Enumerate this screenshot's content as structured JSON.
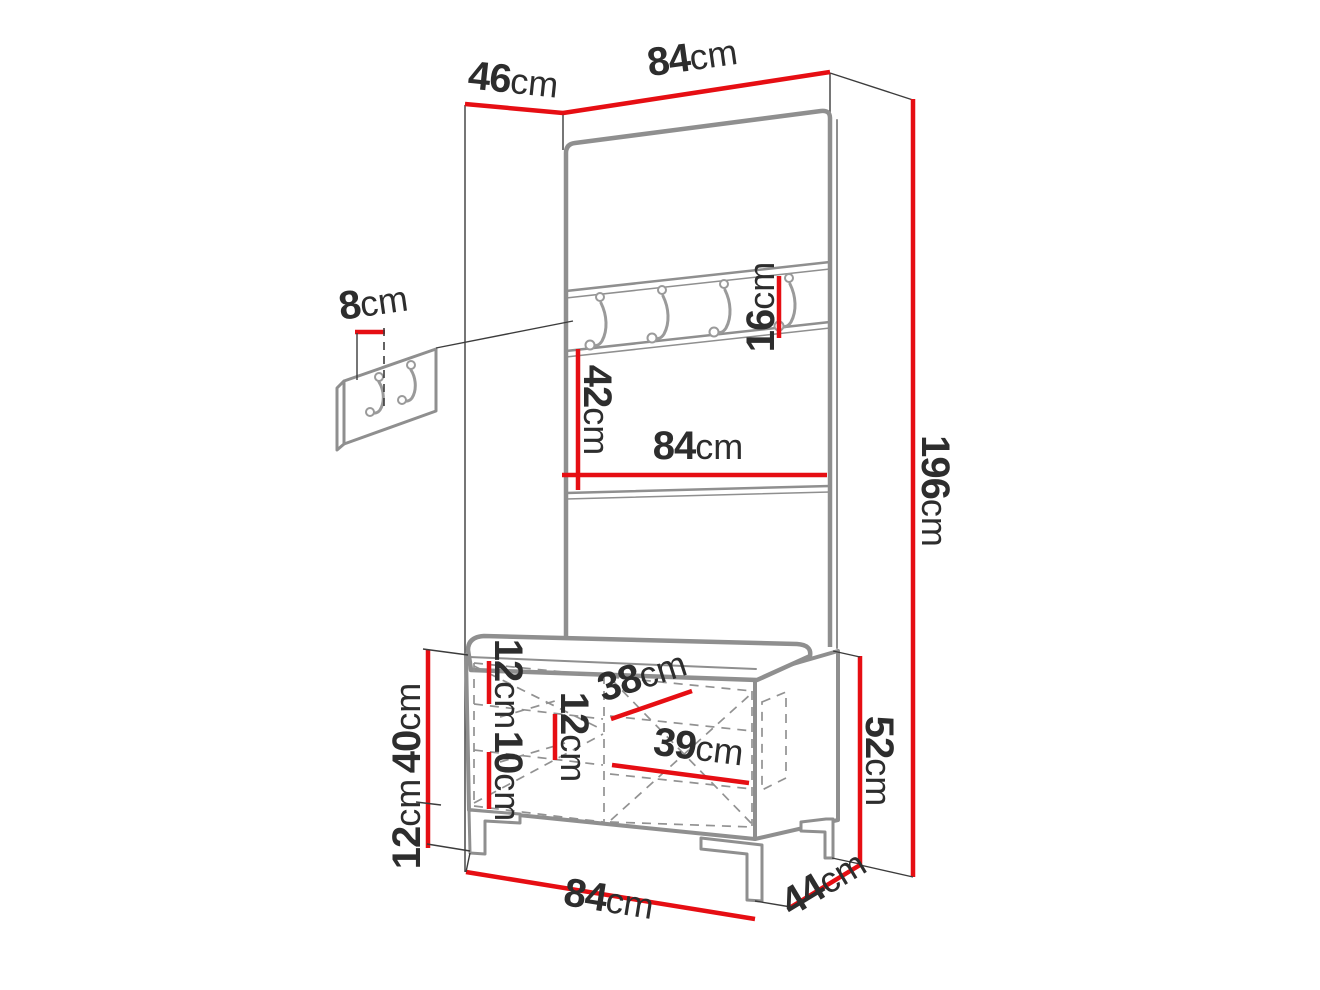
{
  "colors": {
    "dimension_red": "#e60e13",
    "outline_gray": "#8f8f8f",
    "line_black": "#3c3c3c",
    "label_text": "#2d2d2d",
    "background": "#ffffff"
  },
  "dims": {
    "depth_top": {
      "num": "46",
      "unit": "cm"
    },
    "width_top": {
      "num": "84",
      "unit": "cm"
    },
    "total_height": {
      "num": "196",
      "unit": "cm"
    },
    "rail_height": {
      "num": "16",
      "unit": "cm"
    },
    "mirror_height": {
      "num": "42",
      "unit": "cm"
    },
    "panel_width": {
      "num": "84",
      "unit": "cm"
    },
    "hook_panel": {
      "num": "8",
      "unit": "cm"
    },
    "bench_body_height": {
      "num": "40",
      "unit": "cm"
    },
    "leg_height": {
      "num": "12",
      "unit": "cm"
    },
    "shelf_gap_top": {
      "num": "12",
      "unit": "cm"
    },
    "shelf_gap_mid": {
      "num": "12",
      "unit": "cm"
    },
    "shelf_gap_bottom": {
      "num": "10",
      "unit": "cm"
    },
    "compartment_left": {
      "num": "38",
      "unit": "cm"
    },
    "compartment_right": {
      "num": "39",
      "unit": "cm"
    },
    "bench_height": {
      "num": "52",
      "unit": "cm"
    },
    "bench_width": {
      "num": "84",
      "unit": "cm"
    },
    "bench_depth": {
      "num": "44",
      "unit": "cm"
    }
  }
}
